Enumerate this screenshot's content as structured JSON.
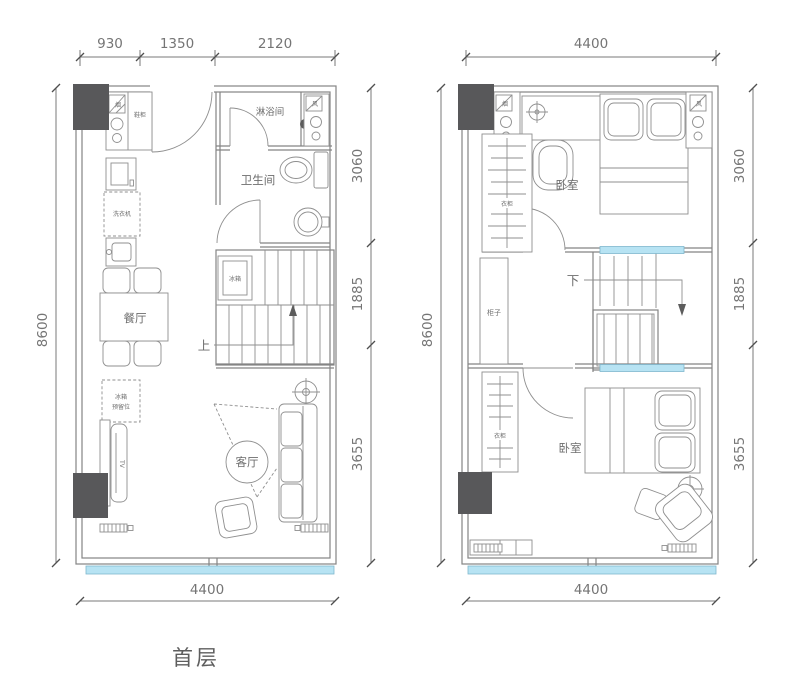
{
  "title": "首层",
  "colors": {
    "line": "#848484",
    "column": "#58585a",
    "window": "#b7e3f3",
    "text": "#6d6d6d"
  },
  "left": {
    "dims": {
      "top": [
        "930",
        "1350",
        "2120"
      ],
      "left": "8600",
      "right": [
        "3060",
        "1885",
        "3655"
      ],
      "bottom": "4400"
    },
    "rooms": {
      "shower": "淋浴间",
      "bathroom": "卫生间",
      "dining": "餐厅",
      "living": "客厅"
    },
    "labels": {
      "hood": "烟",
      "vent": "风",
      "shoe_cabinet": "鞋柜",
      "washer": "洗衣机",
      "fridge": "冰箱",
      "fridge_reserved_1": "冰箱",
      "fridge_reserved_2": "预留位",
      "tv": "TV",
      "up": "上"
    }
  },
  "right": {
    "dims": {
      "top": "4400",
      "left": "8600",
      "right": [
        "3060",
        "1885",
        "3655"
      ],
      "bottom": "4400"
    },
    "rooms": {
      "bedroom_top": "卧室",
      "bedroom_bottom": "卧室"
    },
    "labels": {
      "hood": "烟",
      "vent": "风",
      "wardrobe_top": "衣柜",
      "cabinet": "柜子",
      "wardrobe_bottom": "衣柜",
      "down": "下"
    }
  }
}
